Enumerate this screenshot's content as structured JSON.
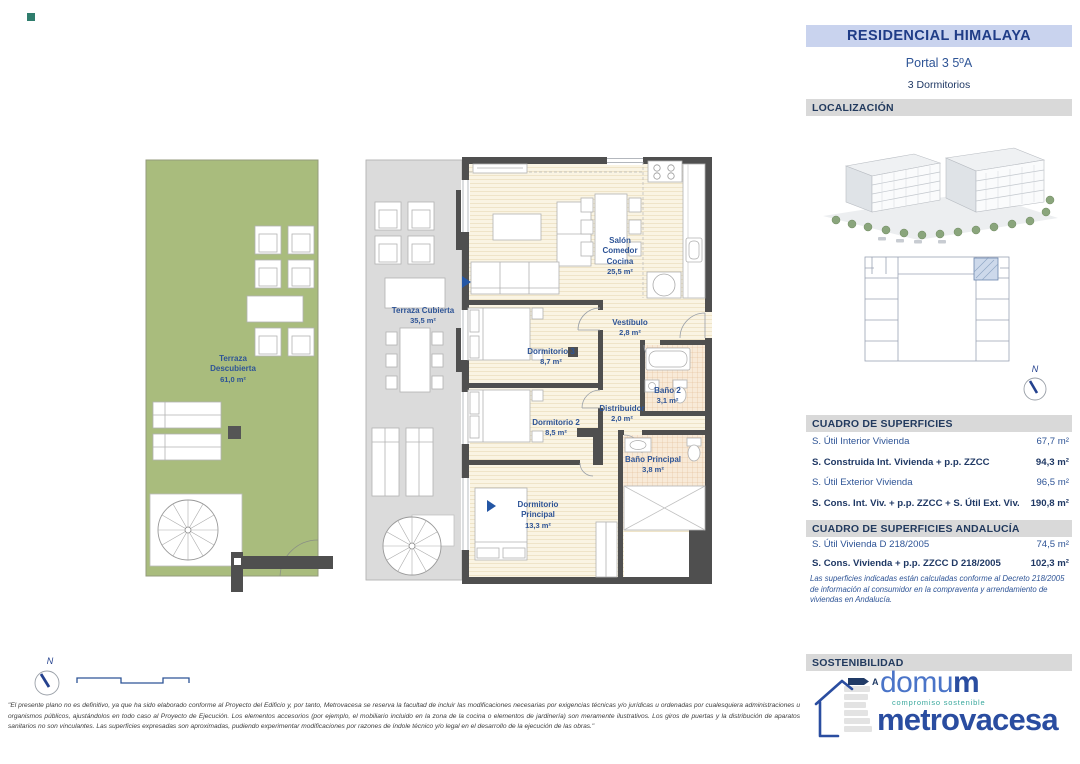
{
  "header": {
    "title": "RESIDENCIAL HIMALAYA",
    "portal": "Portal 3 5ºA",
    "bedrooms": "3 Dormitorios"
  },
  "sections": {
    "localizacion": "LOCALIZACIÓN",
    "superficies": "CUADRO DE SUPERFICIES",
    "andalucia": "CUADRO DE SUPERFICIES ANDALUCÍA",
    "sostenibilidad": "SOSTENIBILIDAD"
  },
  "superficies": {
    "rows": [
      {
        "label": "S. Útil Interior Vivienda",
        "value": "67,7 m²"
      },
      {
        "label": "S. Construida Int. Vivienda + p.p. ZZCC",
        "value": "94,3 m²"
      },
      {
        "label": "S. Útil Exterior Vivienda",
        "value": "96,5 m²"
      },
      {
        "label": "S. Cons. Int. Viv. + p.p. ZZCC + S. Útil Ext. Viv.",
        "value": "190,8 m²"
      }
    ]
  },
  "andalucia": {
    "rows": [
      {
        "label": "S. Útil Vivienda D 218/2005",
        "value": "74,5 m²"
      },
      {
        "label": "S. Cons. Vivienda + p.p. ZZCC D 218/2005",
        "value": "102,3 m²"
      }
    ],
    "note": "Las superficies indicadas están calculadas conforme al Decreto 218/2005 de información al consumidor en la compraventa y arrendamiento de viviendas en Andalucía."
  },
  "plan": {
    "rooms": [
      {
        "name": "Terraza\nDescubierta",
        "area": "61,0 m²"
      },
      {
        "name": "Terraza Cubierta",
        "area": "35,5 m²"
      },
      {
        "name": "Salón\nComedor\nCocina",
        "area": "25,5 m²"
      },
      {
        "name": "Vestíbulo",
        "area": "2,8 m²"
      },
      {
        "name": "Dormitorio 3",
        "area": "8,7 m²"
      },
      {
        "name": "Baño 2",
        "area": "3,1 m²"
      },
      {
        "name": "Distribuidor",
        "area": "2,0 m²"
      },
      {
        "name": "Dormitorio 2",
        "area": "8,5 m²"
      },
      {
        "name": "Baño Principal",
        "area": "3,8 m²"
      },
      {
        "name": "Dormitorio\nPrincipal",
        "area": "13,3 m²"
      }
    ]
  },
  "compass": {
    "north": "N"
  },
  "footer": {
    "disclaimer": "\"El presente plano no es definitivo, ya que ha sido elaborado conforme al Proyecto del Edificio y, por tanto, Metrovacesa se reserva la facultad de incluir las modificaciones necesarias por exigencias técnicas y/o jurídicas u ordenadas por cualesquiera administraciones u organismos públicos, ajustándolos en todo caso al Proyecto de Ejecución. Los elementos accesorios (por ejemplo, el mobiliario incluido en la zona de la cocina o elementos de jardinería) son meramente ilustrativos. Los giros de puertas y la distribución de aparatos sanitarios no son vinculantes. Las superficies expresadas son aproximadas, pudiendo experimentar modificaciones por razones de índole técnico y/o legal en el desarrollo de la ejecución de las obras.\""
  },
  "branding": {
    "energy_rating": "A",
    "domum_prefix": "domu",
    "domum_suffix": "m",
    "domum_tagline": "compromiso sostenible",
    "metrovacesa": "metrovacesa"
  },
  "colors": {
    "accent_navy": "#1f3c87",
    "label_blue": "#2e5496",
    "title_bg": "#c9d3ee",
    "band_bg": "#d9d9d9",
    "terrace_green": "#a9bc7d",
    "terrace_gray": "#dbdbdb",
    "wall_dark": "#4f4f4f",
    "metrovacesa_blue": "#2a4da0",
    "domum_teal": "#3aa89d"
  }
}
